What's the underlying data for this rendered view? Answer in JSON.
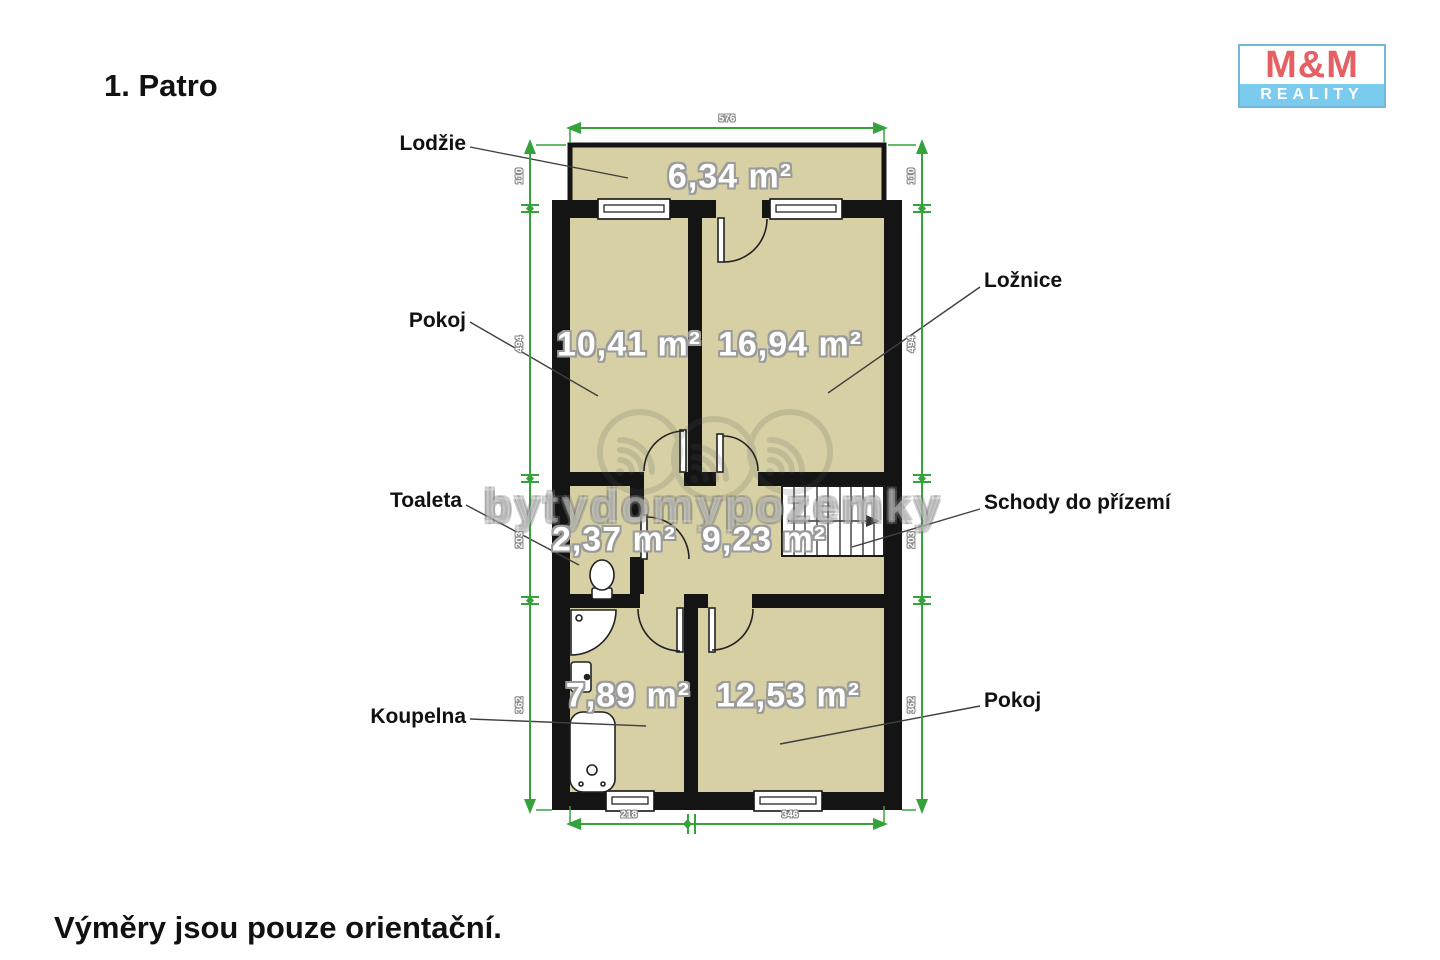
{
  "page": {
    "title": "1. Patro",
    "footnote": "Výměry jsou pouze orientační."
  },
  "logo": {
    "line1": "M&M",
    "line2": "REALITY"
  },
  "watermark": "bytydomypozemky",
  "rooms": [
    {
      "name": "Lodžie",
      "area": "6,34 m²"
    },
    {
      "name": "Pokoj",
      "area": "10,41 m²"
    },
    {
      "name": "Ložnice",
      "area": "16,94 m²"
    },
    {
      "name": "Toaleta",
      "area": "2,37 m²"
    },
    {
      "name": "Schody do přízemí",
      "area": "9,23 m²"
    },
    {
      "name": "Koupelna",
      "area": "7,89 m²"
    },
    {
      "name": "Pokoj",
      "area": "12,53 m²"
    }
  ],
  "dimensions": {
    "top": "576",
    "bottom": [
      "218",
      "346"
    ],
    "left": [
      "110",
      "494",
      "203",
      "362"
    ],
    "right": [
      "110",
      "494",
      "203",
      "362"
    ]
  },
  "colors": {
    "floor": "#d6d0a4",
    "wall": "#141414",
    "dimension_green": "#35a23c",
    "logo_red": "#e55f63",
    "logo_blue": "#7bcbef"
  }
}
